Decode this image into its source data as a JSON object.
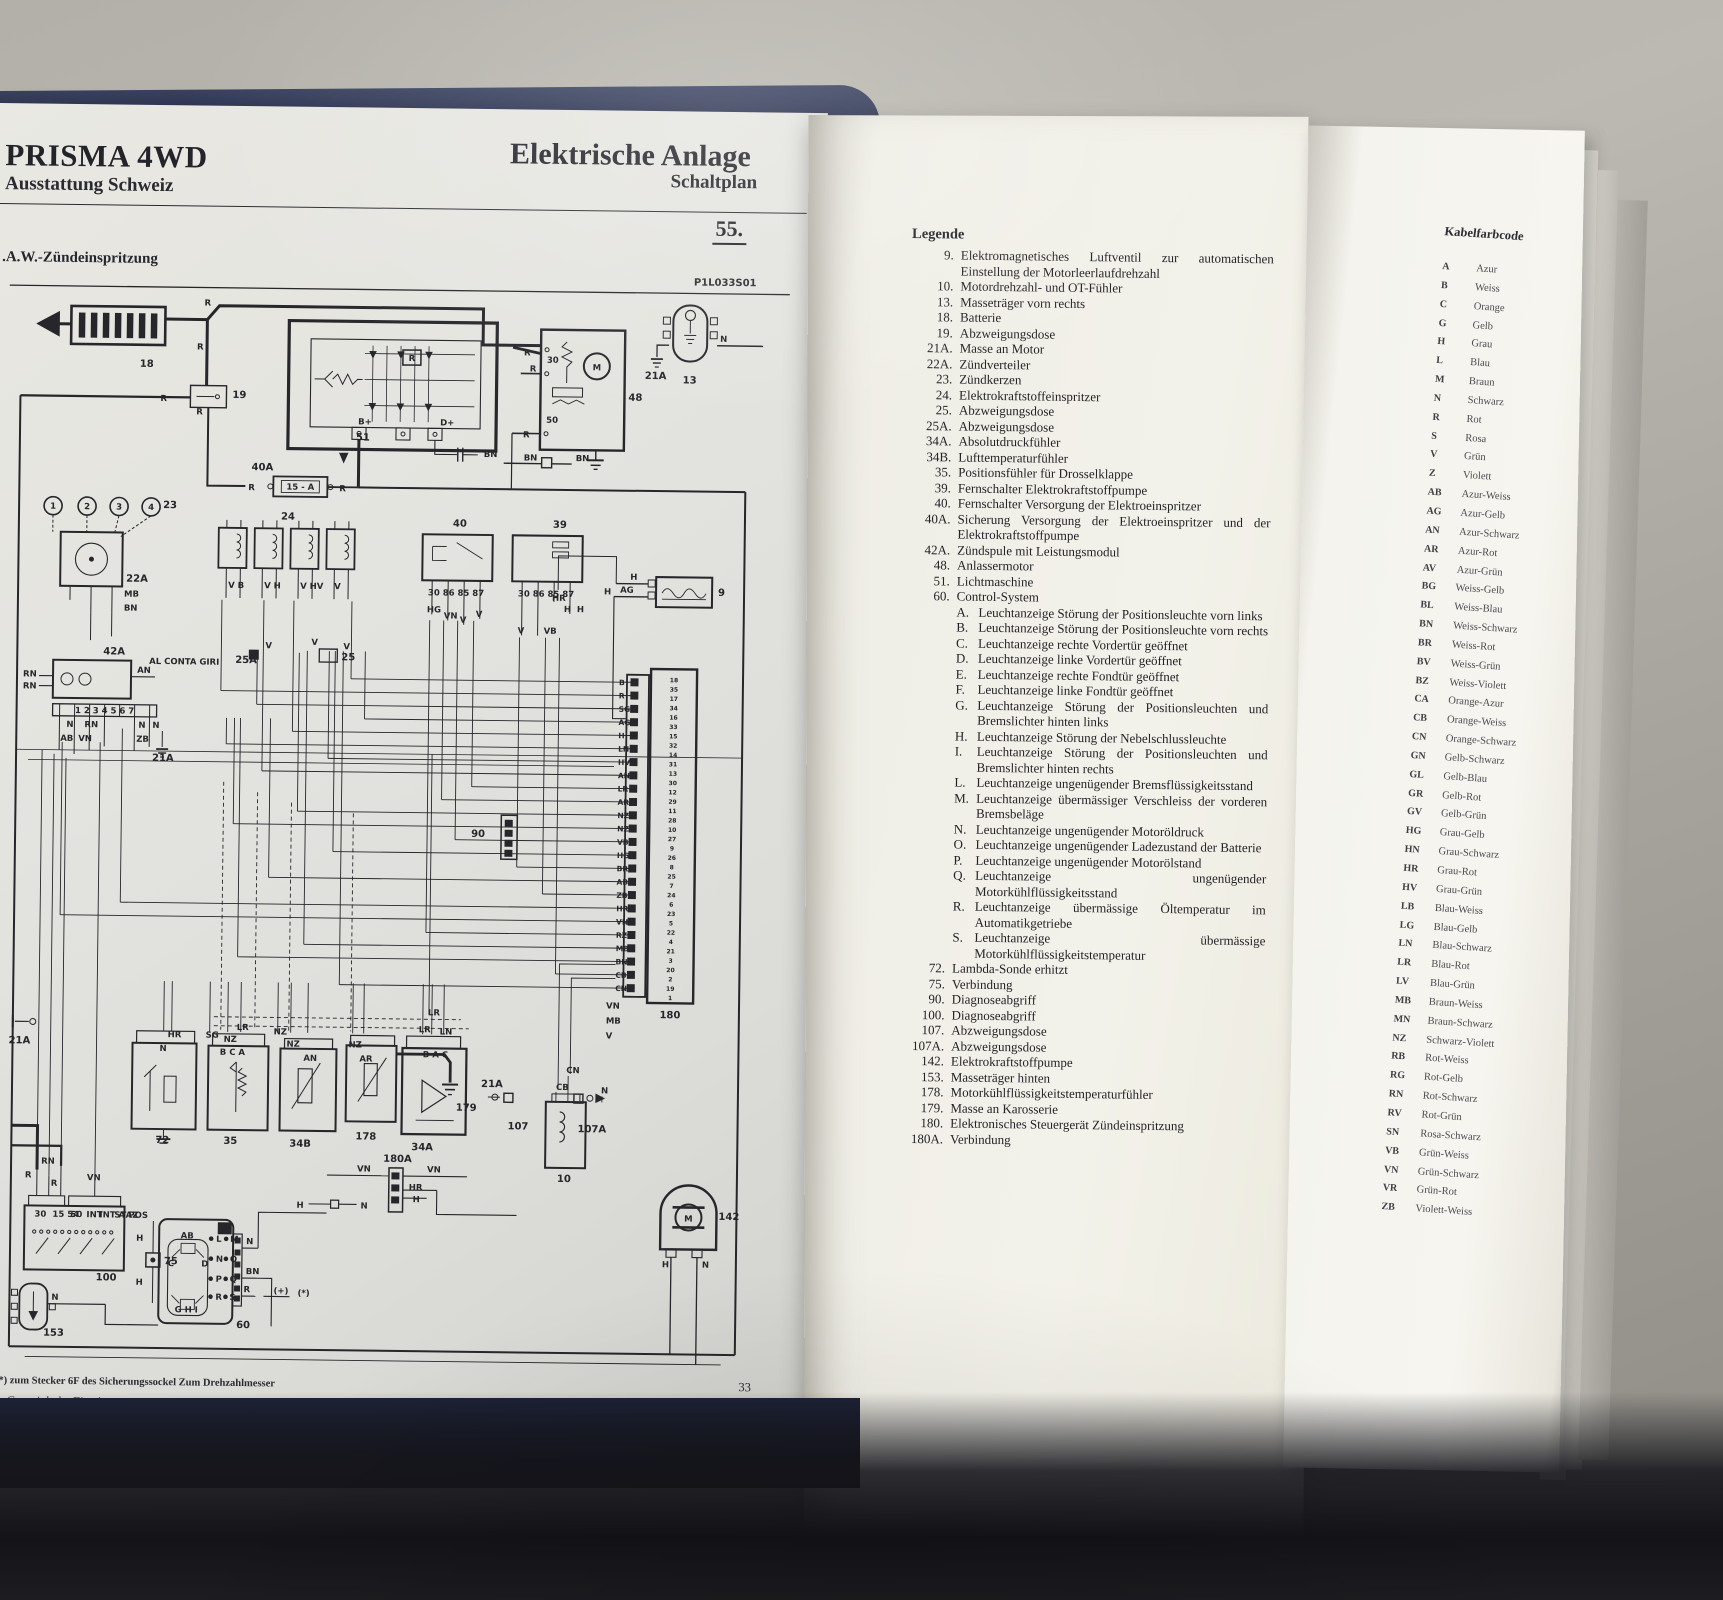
{
  "left_page": {
    "title": "PRISMA 4WD",
    "subtitle": "Ausstattung Schweiz",
    "center_title": "Elektrische Anlage",
    "center_subtitle": "Schaltplan",
    "plan_number": "55.",
    "copyright": "Copyright by Fiat Auto",
    "page_number": "33"
  },
  "diagram": {
    "subtitle": ".A.W.-Zündeinspritzung",
    "code": "P1L033S01",
    "footnote": "*) zum Stecker 6F des Sicherungssockel Zum Drehzahlmesser",
    "components": [
      "18",
      "19",
      "51",
      "48",
      "13",
      "21A",
      "40A",
      "23",
      "22A",
      "24",
      "25A",
      "25",
      "40",
      "39",
      "42A",
      "21A",
      "9",
      "90",
      "180",
      "21A",
      "72",
      "35",
      "34B",
      "178",
      "34A",
      "179",
      "21A",
      "107",
      "107A",
      "10",
      "100",
      "75",
      "153",
      "60",
      "142",
      "180A"
    ],
    "wires": [
      "R",
      "R",
      "R",
      "R",
      "R",
      "R",
      "R",
      "R",
      "R",
      "BN",
      "BN",
      "BN",
      "N",
      "MB",
      "BN",
      "V B",
      "V H",
      "V HV",
      "V",
      "V",
      "V",
      "V",
      "HG",
      "VN",
      "V",
      "V",
      "V",
      "VB",
      "HR",
      "H",
      "H",
      "H",
      "H",
      "AG",
      "RN",
      "RN",
      "AN",
      "N",
      "RN",
      "N",
      "N",
      "AB",
      "VN",
      "ZB",
      "HR",
      "N",
      "SG",
      "NZ",
      "LR",
      "NZ",
      "NZ",
      "AN",
      "NZ",
      "AR",
      "LR",
      "LR",
      "LN",
      "CN",
      "CB",
      "N",
      "VN",
      "MB",
      "V",
      "VN",
      "VN",
      "HR",
      "H",
      "H",
      "N",
      "RN",
      "R",
      "R",
      "VN",
      "H",
      "H",
      "N",
      "N",
      "BN",
      "R",
      "H",
      "N"
    ],
    "micro": [
      "B+",
      "D+",
      "R",
      "30",
      "50",
      "15 - A",
      "AL CONTA GIRI",
      "30 86 85 87",
      "30 86 85 87",
      "B C A",
      "B A C",
      "30",
      "15 54",
      "50",
      "INT",
      "INT A",
      "STAZ",
      "POS",
      "D",
      "(+)",
      "(*)",
      "M",
      "M",
      "1",
      "2",
      "3",
      "4",
      "AB",
      "C",
      "D",
      "G H I",
      "L",
      "M",
      "N",
      "O",
      "P",
      "Q",
      "R",
      "S",
      "1 2 3 4 5 6 7"
    ],
    "ecu_wire_codes": [
      "B",
      "R",
      "SG",
      "AG",
      "H",
      "LN",
      "HV",
      "AN",
      "LR",
      "AR",
      "NZ",
      "NZ",
      "VB",
      "HG",
      "BR",
      "AB",
      "ZB",
      "HR",
      "VN",
      "RZ",
      "MB",
      "BN",
      "CB",
      "CN"
    ],
    "ecu_pin_numbers": [
      "18",
      "35",
      "17",
      "34",
      "16",
      "33",
      "15",
      "32",
      "14",
      "31",
      "13",
      "30",
      "12",
      "29",
      "11",
      "28",
      "10",
      "27",
      "9",
      "26",
      "8",
      "25",
      "7",
      "24",
      "6",
      "23",
      "5",
      "22",
      "4",
      "21",
      "3",
      "20",
      "2",
      "19",
      "1"
    ]
  },
  "legend": {
    "heading": "Legende",
    "items": [
      {
        "num": "9.",
        "text": "Elektromagnetisches Luftventil zur automatischen Einstellung der Motorleerlaufdrehzahl"
      },
      {
        "num": "10.",
        "text": "Motordrehzahl- und OT-Fühler"
      },
      {
        "num": "13.",
        "text": "Masseträger vorn rechts"
      },
      {
        "num": "18.",
        "text": "Batterie"
      },
      {
        "num": "19.",
        "text": "Abzweigungsdose"
      },
      {
        "num": "21A.",
        "text": "Masse an Motor"
      },
      {
        "num": "22A.",
        "text": "Zündverteiler"
      },
      {
        "num": "23.",
        "text": "Zündkerzen"
      },
      {
        "num": "24.",
        "text": "Elektrokraftstoffeinspritzer"
      },
      {
        "num": "25.",
        "text": "Abzweigungsdose"
      },
      {
        "num": "25A.",
        "text": "Abzweigungsdose"
      },
      {
        "num": "34A.",
        "text": "Absolutdruckfühler"
      },
      {
        "num": "34B.",
        "text": "Lufttemperaturfühler"
      },
      {
        "num": "35.",
        "text": "Positionsfühler für Drosselklappe"
      },
      {
        "num": "39.",
        "text": "Fernschalter Elektrokraftstoffpumpe"
      },
      {
        "num": "40.",
        "text": "Fernschalter Versorgung der Elektroeinspritzer"
      },
      {
        "num": "40A.",
        "text": "Sicherung Versorgung der Elektroeinspritzer und der Elektrokraftstoffpumpe"
      },
      {
        "num": "42A.",
        "text": "Zündspule mit Leistungsmodul"
      },
      {
        "num": "48.",
        "text": "Anlassermotor"
      },
      {
        "num": "51.",
        "text": "Lichtmaschine"
      },
      {
        "num": "60.",
        "text": "Control-System",
        "sub": [
          {
            "letter": "A.",
            "text": "Leuchtanzeige Störung der Positionsleuchte vorn links"
          },
          {
            "letter": "B.",
            "text": "Leuchtanzeige Störung der Positionsleuchte vorn rechts"
          },
          {
            "letter": "C.",
            "text": "Leuchtanzeige rechte Vordertür geöffnet"
          },
          {
            "letter": "D.",
            "text": "Leuchtanzeige linke Vordertür geöffnet"
          },
          {
            "letter": "E.",
            "text": "Leuchtanzeige rechte Fondtür geöffnet"
          },
          {
            "letter": "F.",
            "text": "Leuchtanzeige linke Fondtür geöffnet"
          },
          {
            "letter": "G.",
            "text": "Leuchtanzeige Störung der Positionsleuchten und Bremslichter hinten links"
          },
          {
            "letter": "H.",
            "text": "Leuchtanzeige Störung der Nebelschlussleuchte"
          },
          {
            "letter": "I.",
            "text": "Leuchtanzeige Störung der Positionsleuchten und Bremslichter hinten rechts"
          },
          {
            "letter": "L.",
            "text": "Leuchtanzeige ungenügender Bremsflüssigkeitsstand"
          },
          {
            "letter": "M.",
            "text": "Leuchtanzeige übermässiger Verschleiss der vorderen Bremsbeläge"
          },
          {
            "letter": "N.",
            "text": "Leuchtanzeige ungenügender Motoröldruck"
          },
          {
            "letter": "O.",
            "text": "Leuchtanzeige ungenügender Ladezustand der Batterie"
          },
          {
            "letter": "P.",
            "text": "Leuchtanzeige ungenügender Motorölstand"
          },
          {
            "letter": "Q.",
            "text": "Leuchtanzeige ungenügender Motorkühlflüssigkeitsstand"
          },
          {
            "letter": "R.",
            "text": "Leuchtanzeige übermässige Öltemperatur im Automatikgetriebe"
          },
          {
            "letter": "S.",
            "text": "Leuchtanzeige übermässige Motorkühlflüssigkeitstemperatur"
          }
        ]
      },
      {
        "num": "72.",
        "text": "Lambda-Sonde erhitzt"
      },
      {
        "num": "75.",
        "text": "Verbindung"
      },
      {
        "num": "90.",
        "text": "Diagnoseabgriff"
      },
      {
        "num": "100.",
        "text": "Diagnoseabgriff"
      },
      {
        "num": "107.",
        "text": "Abzweigungsdose"
      },
      {
        "num": "107A.",
        "text": "Abzweigungsdose"
      },
      {
        "num": "142.",
        "text": "Elektrokraftstoffpumpe"
      },
      {
        "num": "153.",
        "text": "Masseträger hinten"
      },
      {
        "num": "178.",
        "text": "Motorkühlflüssigkeitstemperaturfühler"
      },
      {
        "num": "179.",
        "text": "Masse an Karosserie"
      },
      {
        "num": "180.",
        "text": "Elektronisches Steuergerät Zündeinspritzung"
      },
      {
        "num": "180A.",
        "text": "Verbindung"
      }
    ]
  },
  "kabelfarbcode": {
    "heading": "Kabelfarbcode",
    "rows": [
      [
        "A",
        "Azur"
      ],
      [
        "B",
        "Weiss"
      ],
      [
        "C",
        "Orange"
      ],
      [
        "G",
        "Gelb"
      ],
      [
        "H",
        "Grau"
      ],
      [
        "L",
        "Blau"
      ],
      [
        "M",
        "Braun"
      ],
      [
        "N",
        "Schwarz"
      ],
      [
        "R",
        "Rot"
      ],
      [
        "S",
        "Rosa"
      ],
      [
        "V",
        "Grün"
      ],
      [
        "Z",
        "Violett"
      ],
      [
        "AB",
        "Azur-Weiss"
      ],
      [
        "AG",
        "Azur-Gelb"
      ],
      [
        "AN",
        "Azur-Schwarz"
      ],
      [
        "AR",
        "Azur-Rot"
      ],
      [
        "AV",
        "Azur-Grün"
      ],
      [
        "BG",
        "Weiss-Gelb"
      ],
      [
        "BL",
        "Weiss-Blau"
      ],
      [
        "BN",
        "Weiss-Schwarz"
      ],
      [
        "BR",
        "Weiss-Rot"
      ],
      [
        "BV",
        "Weiss-Grün"
      ],
      [
        "BZ",
        "Weiss-Violett"
      ],
      [
        "CA",
        "Orange-Azur"
      ],
      [
        "CB",
        "Orange-Weiss"
      ],
      [
        "CN",
        "Orange-Schwarz"
      ],
      [
        "GN",
        "Gelb-Schwarz"
      ],
      [
        "GL",
        "Gelb-Blau"
      ],
      [
        "GR",
        "Gelb-Rot"
      ],
      [
        "GV",
        "Gelb-Grün"
      ],
      [
        "HG",
        "Grau-Gelb"
      ],
      [
        "HN",
        "Grau-Schwarz"
      ],
      [
        "HR",
        "Grau-Rot"
      ],
      [
        "HV",
        "Grau-Grün"
      ],
      [
        "LB",
        "Blau-Weiss"
      ],
      [
        "LG",
        "Blau-Gelb"
      ],
      [
        "LN",
        "Blau-Schwarz"
      ],
      [
        "LR",
        "Blau-Rot"
      ],
      [
        "LV",
        "Blau-Grün"
      ],
      [
        "MB",
        "Braun-Weiss"
      ],
      [
        "MN",
        "Braun-Schwarz"
      ],
      [
        "NZ",
        "Schwarz-Violett"
      ],
      [
        "RB",
        "Rot-Weiss"
      ],
      [
        "RG",
        "Rot-Gelb"
      ],
      [
        "RN",
        "Rot-Schwarz"
      ],
      [
        "RV",
        "Rot-Grün"
      ],
      [
        "SN",
        "Rosa-Schwarz"
      ],
      [
        "VB",
        "Grün-Weiss"
      ],
      [
        "VN",
        "Grün-Schwarz"
      ],
      [
        "VR",
        "Grün-Rot"
      ],
      [
        "ZB",
        "Violett-Weiss"
      ]
    ]
  }
}
